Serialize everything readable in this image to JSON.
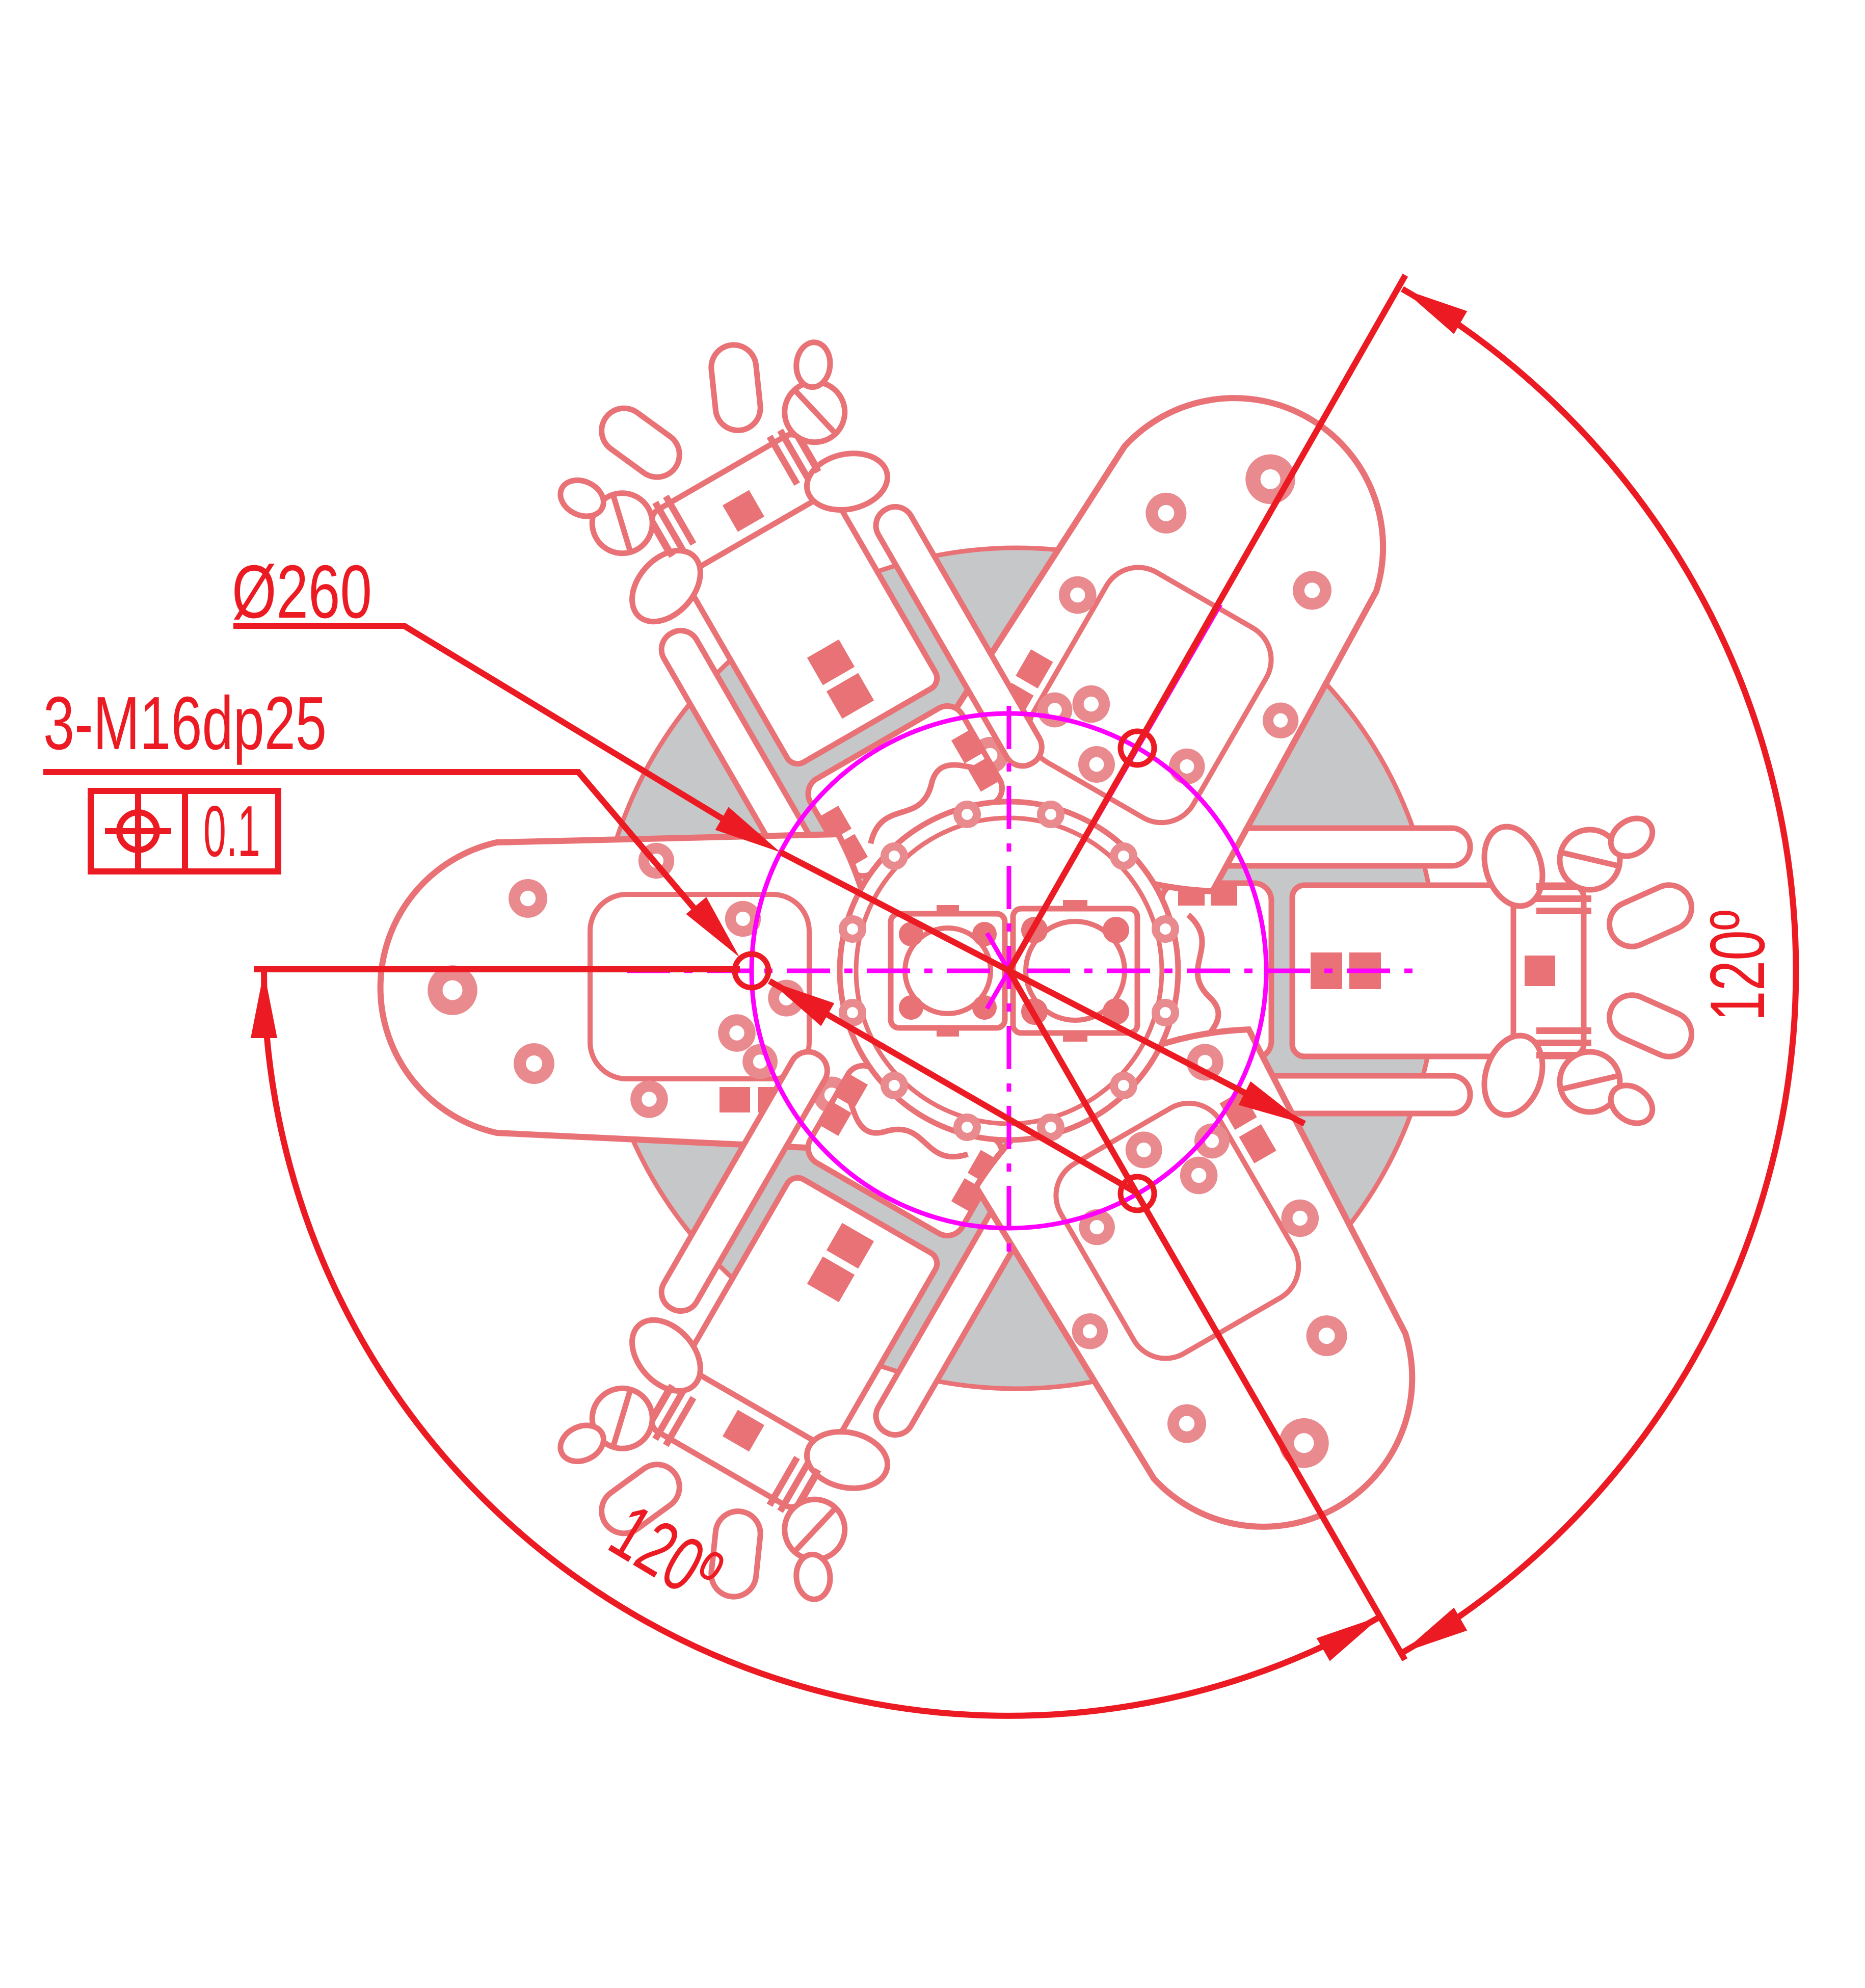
{
  "drawing_title": "three-jaw-chuck-fixture-top-view",
  "callouts": {
    "bolt_circle_diameter": "Ø260",
    "thread_spec": "3-M16dp25",
    "position_tolerance_value": "0.1",
    "angle_right": "120º",
    "angle_bottom_left": "120º"
  },
  "icons": {
    "position_tolerance_symbol": "position-tolerance-icon"
  },
  "colors": {
    "dimension_red": "#EC1B23",
    "geometry_salmon": "#E97276",
    "bolt_head_salmon": "#E98A8E",
    "centerline_magenta": "#FF00FF",
    "base_plate_gray": "#C6C7C9",
    "background": "#FFFFFF"
  }
}
